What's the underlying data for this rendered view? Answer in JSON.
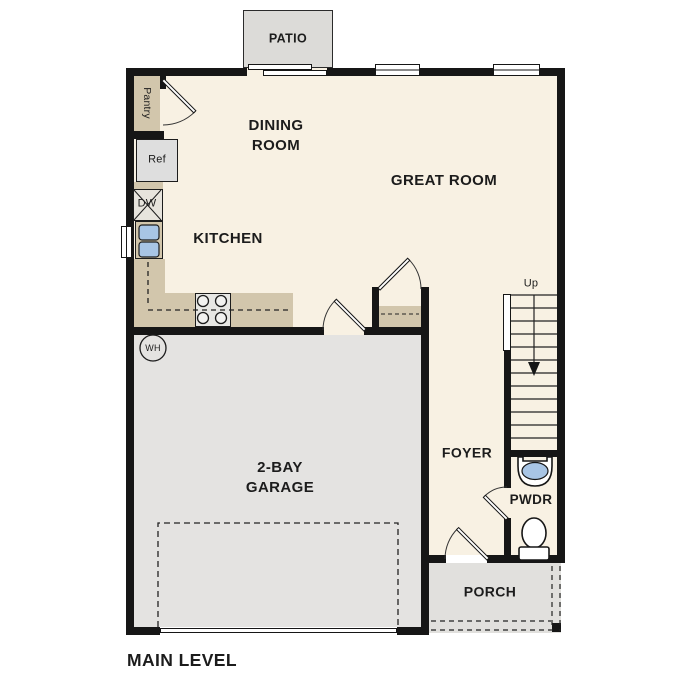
{
  "plan": {
    "title": "MAIN LEVEL"
  },
  "rooms": {
    "patio": {
      "label": "PATIO"
    },
    "dining_room": {
      "label": "DINING\nROOM"
    },
    "great_room": {
      "label": "GREAT ROOM"
    },
    "kitchen": {
      "label": "KITCHEN"
    },
    "garage": {
      "label": "2-BAY\nGARAGE"
    },
    "foyer": {
      "label": "FOYER"
    },
    "powder_room": {
      "label": "PWDR"
    },
    "porch": {
      "label": "PORCH"
    }
  },
  "fixtures": {
    "pantry": {
      "label": "Pantry"
    },
    "refrigerator": {
      "label": "Ref"
    },
    "dishwasher": {
      "label": "DW"
    },
    "water_heater": {
      "label": "WH"
    },
    "stairs": {
      "label": "Up"
    }
  },
  "colors": {
    "wall": "#161616",
    "floor": "#f8f1e3",
    "garage_floor": "#e4e3e1",
    "patio": "#dcdbd8",
    "porch": "#e1e0dd",
    "counter": "#d2c6ac",
    "water": "#a8c5e5",
    "appliance": "#dedede"
  }
}
